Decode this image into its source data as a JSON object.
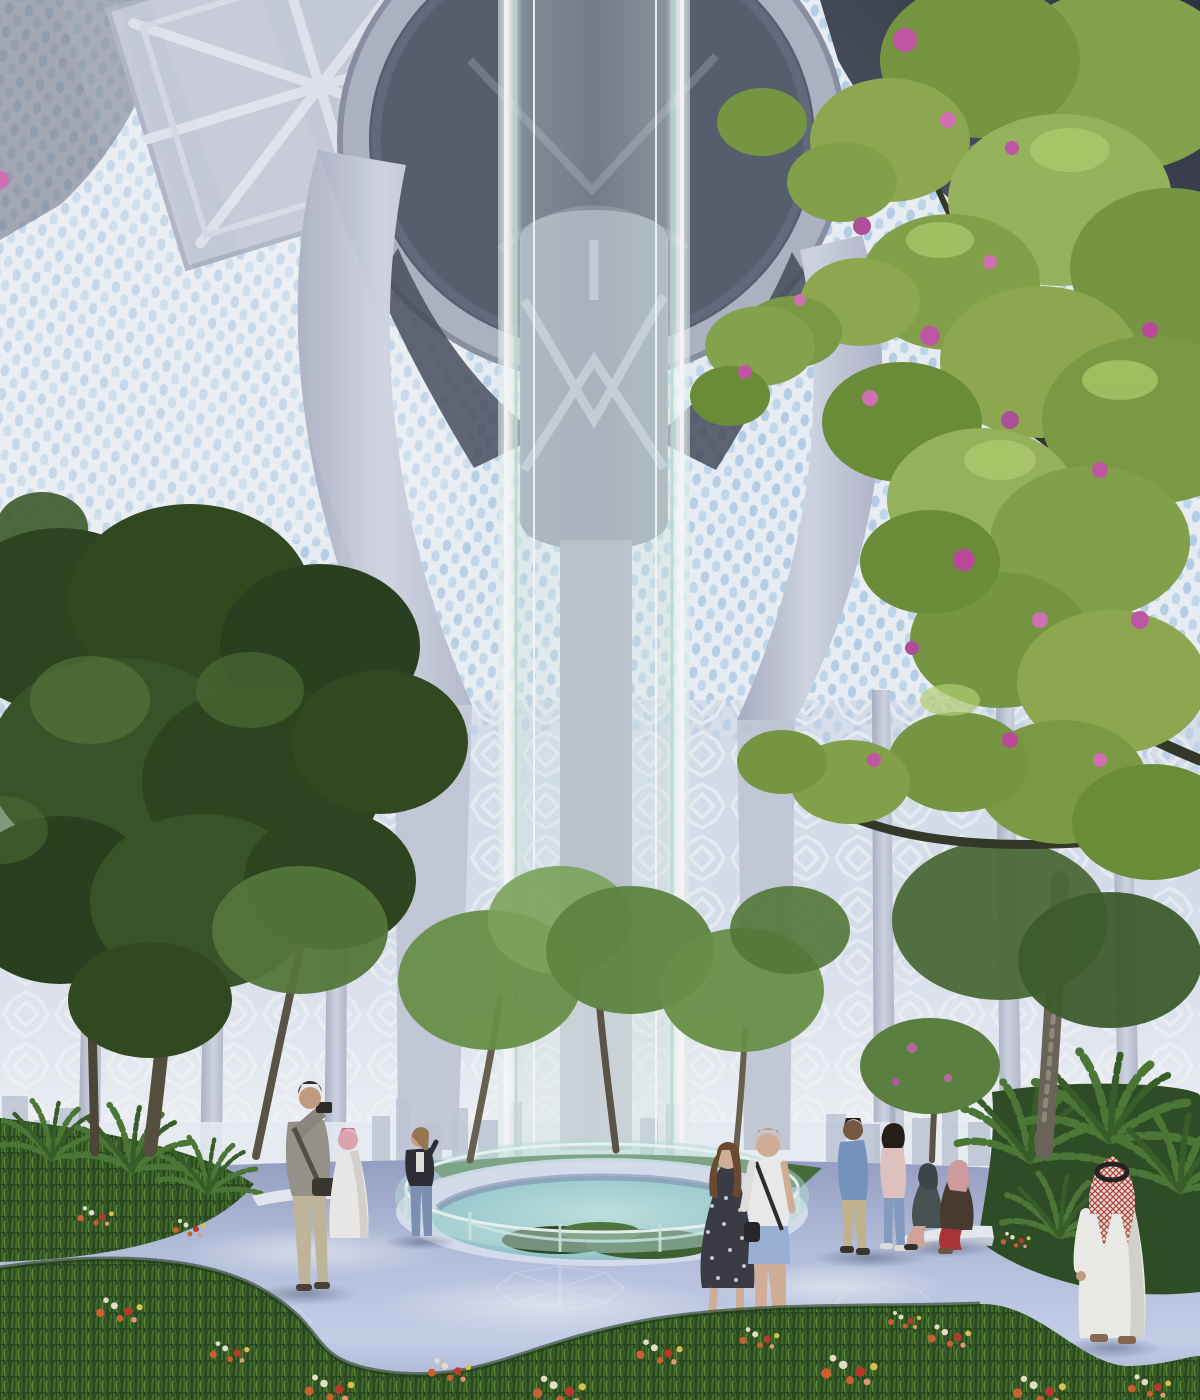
{
  "scene": {
    "type": "architectural-rendering",
    "setting": "Sunlit skyscraper atrium garden with central glass elevator shaft, perforated mashrabiya facade, indoor trees, flower meadow and visitors"
  },
  "palette": {
    "sky_glow": "#dfeefb",
    "lattice_white": "#f2f6fb",
    "lattice_sky_hole": "#b7d2ec",
    "ceiling_dark": "#3d4150",
    "structure_light": "#ccd1df",
    "glass_tint": "#d7ece4",
    "core_gray": "#a3a9b8",
    "foliage_dark": "#33491f",
    "foliage_light": "#93ad52",
    "blossom_pink": "#c758a8",
    "pavement": "#b9c3e0",
    "grass": "#2b4a1e",
    "flower_orange": "#d2622e",
    "flower_cream": "#ece6cc",
    "flower_red": "#c03a2a",
    "bench_white": "#eef0f5",
    "skyline_haze": "#a6afc4",
    "keffiyeh_red": "#b84238",
    "thobe_white": "#f4f3ef"
  },
  "labels": {
    "stage": "Atrium garden architectural rendering",
    "backdrop": "Hazy daylight backdrop",
    "walls": "Perforated mashrabiya lattice walls with sky showing through",
    "skyline": "Distant city skyline seen through the glazed base",
    "ceiling": "Sculptural canopy ribs converging on a circular oculus",
    "oculus": "Circular oculus ring at canopy center",
    "core": "Structural core with star bracing behind the shaft",
    "shaft": "Full-height cylindrical glass elevator shaft",
    "ground": "Patterned plaza pavement",
    "pool": "Sunken circular planted pool with glass balustrade",
    "benches": "Curved white bench",
    "left_trees": "Dark green atrium trees on the left",
    "mid_trees": "Slender trees around the central pool",
    "right_tree": "Large leafy tree with pink blossoms on the right",
    "ferns": "Fern underplanting",
    "meadow": "Foreground flower meadow",
    "rays": "Soft diagonal daylight rays",
    "people": {
      "photographer": "Photographer in beige taking a picture",
      "robed_visitor": "Visitor in white robe with pink head wrap",
      "standing_woman": "Woman in black jacket by the pool railing",
      "strolling_couple": "Couple strolling: woman in patterned dress, man in white tee and denim shorts",
      "walking_couple": "Couple walking: man in blue shirt, woman in pink top",
      "seated_women": "Two women seated on the curved bench",
      "thobe_man": "Man in white thobe and red-checked keffiyeh seen from behind"
    }
  }
}
